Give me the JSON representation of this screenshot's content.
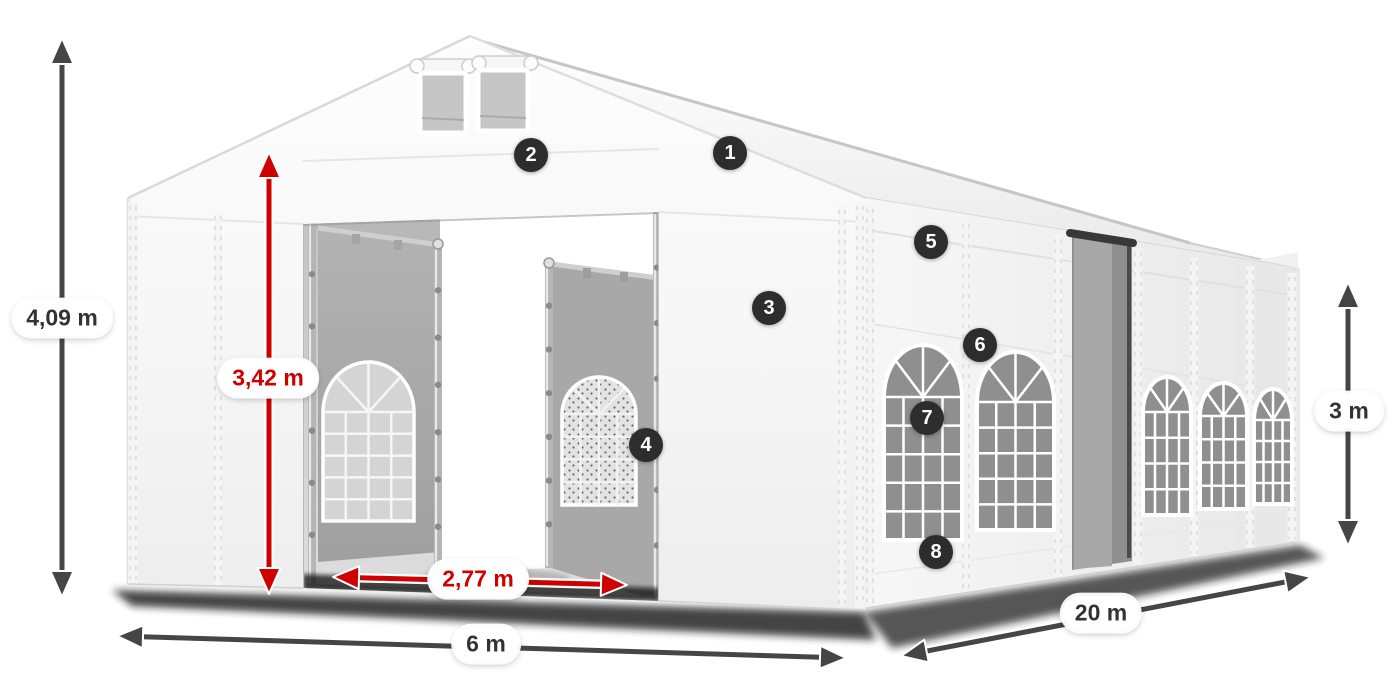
{
  "figure": {
    "type": "product-dimension-diagram",
    "subject": "White 6 x 20 m marquee tent with open front entrance, side door, arched windows and numbered feature markers",
    "background": "#ffffff"
  },
  "dimensions": {
    "total_height": {
      "label": "4,09 m",
      "style": "dark"
    },
    "entrance_height": {
      "label": "3,42 m",
      "style": "red"
    },
    "entrance_width": {
      "label": "2,77 m",
      "style": "red"
    },
    "front_width": {
      "label": "6 m",
      "style": "dark"
    },
    "side_length": {
      "label": "20 m",
      "style": "dark"
    },
    "side_height": {
      "label": "3 m",
      "style": "dark"
    }
  },
  "markers": [
    {
      "label": "1"
    },
    {
      "label": "2"
    },
    {
      "label": "3"
    },
    {
      "label": "4"
    },
    {
      "label": "5"
    },
    {
      "label": "6"
    },
    {
      "label": "7"
    },
    {
      "label": "8"
    }
  ],
  "colors": {
    "dimension_red": "#ce0000",
    "dimension_gray": "#454545",
    "marker_bg": "#2d2d2d",
    "marker_text": "#ffffff",
    "pill_bg": "#ffffff",
    "pill_text_dark": "#333333"
  }
}
